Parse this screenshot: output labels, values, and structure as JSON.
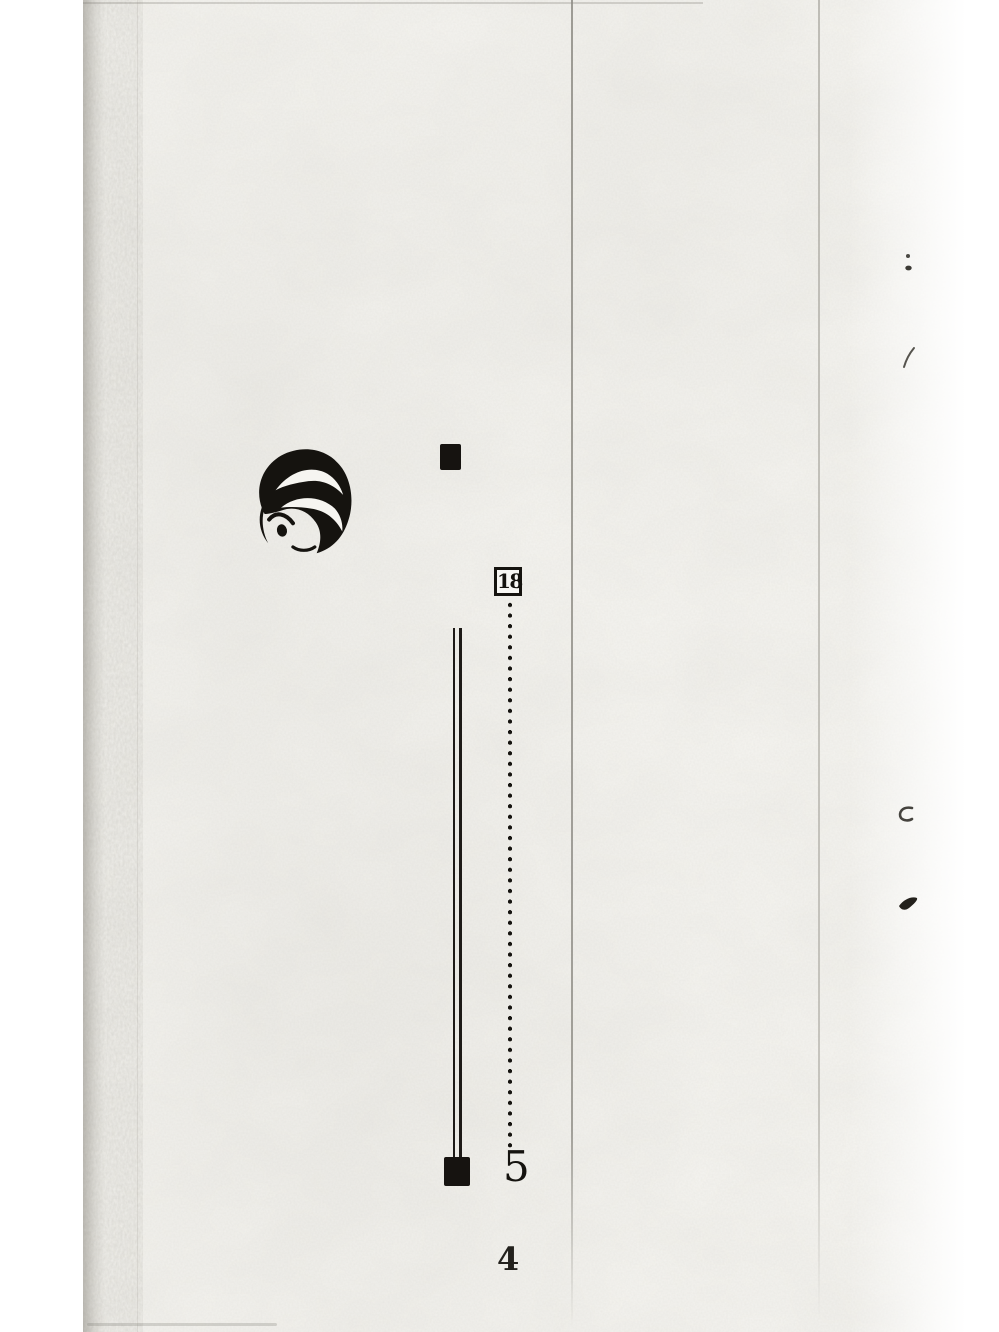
{
  "page": {
    "kind": "scanned-book-page",
    "page_number": "4",
    "colors": {
      "background": "#ffffff",
      "paper": "#f6f5f1",
      "ink": "#15130f",
      "center_rule_line": "#8f8d86",
      "right_rule_line": "#b2b0a9"
    }
  },
  "diagram": {
    "node_box_label": "18",
    "answer_label": "5"
  },
  "icons": {
    "logo": "swirl-face-logo",
    "top_marker": "filled-square-marker",
    "bottom_marker": "filled-square-marker",
    "double_line": "vertical-double-line",
    "dotted_line": "vertical-dotted-line",
    "stray_marks": [
      "ink-mark-colon",
      "ink-mark-check",
      "ink-mark-curl",
      "ink-mark-blob"
    ]
  }
}
